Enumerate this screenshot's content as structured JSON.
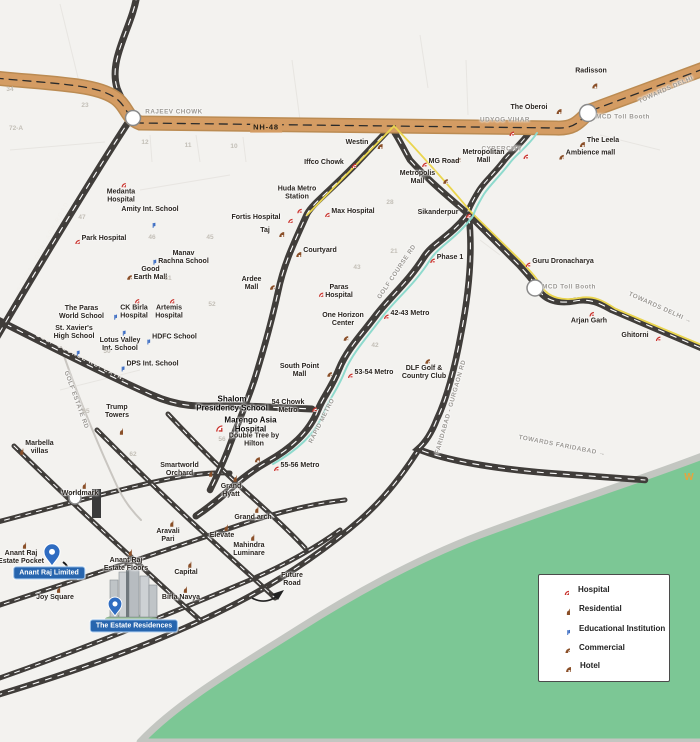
{
  "colors": {
    "nh48_orange": "#d49c63",
    "road_dark": "#3f3c39",
    "rapid_metro_teal": "#8edacd",
    "metro_line_yellow": "#ead54e",
    "green_area": "#7cc795",
    "badge_blue": "#2765ae",
    "pin_blue": "#2f6cc1",
    "icon_brown": "#8a4f28",
    "metro_red": "#c9342e",
    "edu_blue": "#3f6fc4"
  },
  "legend": {
    "items": [
      {
        "icon": "hosp",
        "label": "Hospital"
      },
      {
        "icon": "res",
        "label": "Residential"
      },
      {
        "icon": "edu",
        "label": "Educational Institution"
      },
      {
        "icon": "comm",
        "label": "Commercial"
      },
      {
        "icon": "hotel",
        "label": "Hotel"
      }
    ]
  },
  "places": [
    {
      "n": "rajeev-chowk",
      "l": "RAJEEV CHOWK",
      "x": 174,
      "y": 112,
      "c": "cap"
    },
    {
      "n": "udyog-vihar",
      "l": "UDYOG VIHAR",
      "x": 505,
      "y": 120,
      "c": "cap"
    },
    {
      "n": "mcd-toll-booth-top",
      "l": "MCD Toll Booth",
      "x": 623,
      "y": 117,
      "c": "cap"
    },
    {
      "n": "towards-delhi-top",
      "l": "TOWARDS DELHI",
      "x": 666,
      "y": 90,
      "c": "cap",
      "r": -24
    },
    {
      "n": "cybercity",
      "l": "CYBERCITY",
      "x": 502,
      "y": 149,
      "c": "cap"
    },
    {
      "n": "mcd-toll-booth-right",
      "l": "MCD Toll Booth",
      "x": 569,
      "y": 287,
      "c": "cap"
    },
    {
      "n": "towards-delhi-right",
      "l": "TOWARDS DELHI →",
      "x": 660,
      "y": 308,
      "c": "cap",
      "r": 24
    },
    {
      "n": "towards-faridabad",
      "l": "TOWARDS FARIDABAD →",
      "x": 562,
      "y": 446,
      "c": "cap",
      "r": 11
    },
    {
      "n": "sohna-gurgaon-road",
      "l": "SOHNA - GURGAON ROAD",
      "x": 44,
      "y": 247,
      "c": "onroad",
      "r": -61
    },
    {
      "n": "golf-course-rd-extn",
      "l": "GOLF COURSE RD. EXTN.",
      "x": 80,
      "y": 358,
      "c": "onroad",
      "r": 27
    },
    {
      "n": "nh-48",
      "l": "NH-48",
      "x": 266,
      "y": 128,
      "c": "nh"
    },
    {
      "n": "golf-estate-rd",
      "l": "GOLF ESTATE RD",
      "x": 76,
      "y": 400,
      "c": "cap",
      "r": 70
    },
    {
      "n": "golf-course-rd",
      "l": "GOLF COURSE RD",
      "x": 397,
      "y": 272,
      "c": "cap",
      "r": -56
    },
    {
      "n": "rapid-metro",
      "l": "RAPID METRO",
      "x": 322,
      "y": 421,
      "c": "cap",
      "r": -63
    },
    {
      "n": "faridabad-gurgaon-rd",
      "l": "FARIDABAD - GURGAON RD",
      "x": 451,
      "y": 407,
      "c": "cap",
      "r": -74
    },
    {
      "n": "radisson",
      "l": "Radisson",
      "x": 591,
      "y": 78,
      "ic": "hotel",
      "s": "bottom"
    },
    {
      "n": "the-oberoi",
      "l": "The Oberoi",
      "x": 536,
      "y": 108,
      "ic": "hotel",
      "s": "right"
    },
    {
      "n": "the-leela",
      "l": "The Leela",
      "x": 596,
      "y": 141,
      "ic": "hotel",
      "s": "left"
    },
    {
      "n": "westin",
      "l": "Westin",
      "x": 364,
      "y": 143,
      "ic": "hotel",
      "s": "right"
    },
    {
      "n": "taj",
      "l": "Taj",
      "x": 272,
      "y": 231,
      "ic": "hotel",
      "s": "right"
    },
    {
      "n": "courtyard",
      "l": "Courtyard",
      "x": 313,
      "y": 251,
      "ic": "hotel",
      "s": "left"
    },
    {
      "n": "double-tree-hilton",
      "l": "Double Tree by\nHilton",
      "x": 254,
      "y": 447,
      "ic": "hotel",
      "s": "bottom"
    },
    {
      "n": "ambience-mall",
      "l": "Ambience mall",
      "x": 584,
      "y": 154,
      "ic": "comm",
      "s": "left"
    },
    {
      "n": "metropolitan-mall",
      "l": "Metropolitan\nMall",
      "x": 477,
      "y": 157,
      "ic": "comm",
      "s": "left"
    },
    {
      "n": "metropolis-mall",
      "l": "Metropolis\nMall",
      "x": 424,
      "y": 178,
      "ic": "comm",
      "s": "right"
    },
    {
      "n": "good-earth-mall",
      "l": "Good\nEarth Mall",
      "x": 144,
      "y": 274,
      "ic": "comm",
      "s": "left"
    },
    {
      "n": "ardee-mall",
      "l": "Ardee\nMall",
      "x": 258,
      "y": 284,
      "ic": "comm",
      "s": "right"
    },
    {
      "n": "one-horizon-center",
      "l": "One Horizon\nCenter",
      "x": 343,
      "y": 326,
      "ic": "comm",
      "s": "bottom"
    },
    {
      "n": "south-point-mall",
      "l": "South Point\nMall",
      "x": 306,
      "y": 371,
      "ic": "comm",
      "s": "right"
    },
    {
      "n": "dlf-golf-country-club",
      "l": "DLF Golf &\nCountry Club",
      "x": 424,
      "y": 367,
      "ic": "comm",
      "s": "top"
    },
    {
      "n": "medanta-hospital",
      "l": "Medanta\nHospital",
      "x": 121,
      "y": 191,
      "ic": "hosp",
      "s": "top"
    },
    {
      "n": "park-hospital",
      "l": "Park Hospital",
      "x": 98,
      "y": 239,
      "ic": "hosp",
      "s": "left"
    },
    {
      "n": "ck-birla-hospital",
      "l": "CK Birla\nHospital",
      "x": 134,
      "y": 307,
      "ic": "hosp",
      "s": "top"
    },
    {
      "n": "artemis-hospital",
      "l": "Artemis\nHospital",
      "x": 169,
      "y": 307,
      "ic": "hosp",
      "s": "top"
    },
    {
      "n": "fortis-hospital",
      "l": "Fortis Hospital",
      "x": 262,
      "y": 218,
      "ic": "hosp",
      "s": "right"
    },
    {
      "n": "max-hospital",
      "l": "Max Hospital",
      "x": 347,
      "y": 212,
      "ic": "hosp",
      "s": "left"
    },
    {
      "n": "paras-hospital",
      "l": "Paras\nHospital",
      "x": 333,
      "y": 292,
      "ic": "hosp",
      "s": "left"
    },
    {
      "n": "amity-school",
      "l": "Amity Int. School",
      "x": 150,
      "y": 217,
      "ic": "edu",
      "s": "bottom"
    },
    {
      "n": "manav-rachna-school",
      "l": "Manav\nRachna School",
      "x": 177,
      "y": 258,
      "ic": "edu",
      "s": "left"
    },
    {
      "n": "paras-world-school",
      "l": "The Paras\nWorld School",
      "x": 88,
      "y": 313,
      "ic": "edu",
      "s": "right"
    },
    {
      "n": "lotus-valley-school",
      "l": "Lotus Valley\nInt. School",
      "x": 120,
      "y": 338,
      "ic": "edu",
      "s": "top"
    },
    {
      "n": "hdfc-school",
      "l": "HDFC School",
      "x": 168,
      "y": 338,
      "ic": "edu",
      "s": "left"
    },
    {
      "n": "st-xaviers-school",
      "l": "St. Xavier's\nHigh School",
      "x": 74,
      "y": 340,
      "ic": "edu",
      "s": "bottom"
    },
    {
      "n": "dps-school",
      "l": "DPS Int. School",
      "x": 146,
      "y": 365,
      "ic": "edu",
      "s": "left"
    },
    {
      "n": "iffco-chowk-metro",
      "l": "Iffco Chowk",
      "x": 330,
      "y": 163,
      "ic": "metro",
      "s": "right"
    },
    {
      "n": "mg-road-metro",
      "l": "MG Road",
      "x": 438,
      "y": 162,
      "ic": "metro",
      "s": "left"
    },
    {
      "n": "huda-metro-station",
      "l": "Huda Metro\nStation",
      "x": 297,
      "y": 199,
      "ic": "metro",
      "s": "bottom"
    },
    {
      "n": "sikanderpur-metro",
      "l": "Sikanderpur",
      "x": 444,
      "y": 213,
      "ic": "metro",
      "s": "right"
    },
    {
      "n": "phase-1-metro",
      "l": "Phase 1",
      "x": 444,
      "y": 258,
      "ic": "metro",
      "s": "left"
    },
    {
      "n": "metro-42-43",
      "l": "42-43 Metro",
      "x": 404,
      "y": 314,
      "ic": "metro",
      "s": "left"
    },
    {
      "n": "metro-53-54",
      "l": "53-54 Metro",
      "x": 368,
      "y": 373,
      "ic": "metro",
      "s": "left"
    },
    {
      "n": "metro-54-chowk",
      "l": "54 Chowk\nMetro",
      "x": 294,
      "y": 407,
      "ic": "metro",
      "s": "right"
    },
    {
      "n": "metro-55-56",
      "l": "55-56 Metro",
      "x": 294,
      "y": 466,
      "ic": "metro",
      "s": "left"
    },
    {
      "n": "guru-dronacharya-metro",
      "l": "Guru Dronacharya",
      "x": 557,
      "y": 262,
      "ic": "metro",
      "s": "left"
    },
    {
      "n": "arjan-garh-metro",
      "l": "Arjan Garh",
      "x": 589,
      "y": 316,
      "ic": "metro",
      "s": "top"
    },
    {
      "n": "ghitorni-metro",
      "l": "Ghitorni",
      "x": 641,
      "y": 336,
      "ic": "metro",
      "s": "right"
    },
    {
      "n": "udyog-vihar-metro",
      "l": "",
      "x": 509,
      "y": 131,
      "ic": "metro"
    },
    {
      "n": "cybercity-metro",
      "l": "",
      "x": 523,
      "y": 154,
      "ic": "metro"
    },
    {
      "n": "shalom-presidency-school",
      "l": "Shalom\nPresidency School",
      "x": 232,
      "y": 404,
      "c": "big"
    },
    {
      "n": "marengo-asia-hospital",
      "l": "Marengo Asia\nHospital",
      "x": 243,
      "y": 425,
      "ic": "cross",
      "s": "left",
      "c": "big"
    },
    {
      "n": "trump-towers",
      "l": "Trump\nTowers",
      "x": 117,
      "y": 419,
      "ic": "res",
      "s": "bottom"
    },
    {
      "n": "marbella-villas",
      "l": "Marbella\nvillas",
      "x": 33,
      "y": 448,
      "ic": "res",
      "s": "left"
    },
    {
      "n": "worldmark",
      "l": "Worldmark",
      "x": 80,
      "y": 487,
      "ic": "res",
      "s": "top"
    },
    {
      "n": "smartworld-orchard",
      "l": "Smartworld\nOrchard",
      "x": 186,
      "y": 470,
      "ic": "res",
      "s": "right"
    },
    {
      "n": "grand-hyatt",
      "l": "Grand\nHyatt",
      "x": 231,
      "y": 484,
      "ic": "res",
      "s": "top"
    },
    {
      "n": "grand-arch",
      "l": "Grand arch",
      "x": 253,
      "y": 511,
      "ic": "res",
      "s": "top"
    },
    {
      "n": "elevate",
      "l": "Elevate",
      "x": 222,
      "y": 529,
      "ic": "res",
      "s": "top"
    },
    {
      "n": "mahindra-luminare",
      "l": "Mahindra\nLuminare",
      "x": 249,
      "y": 543,
      "ic": "res",
      "s": "top"
    },
    {
      "n": "aravali-pari",
      "l": "Aravali\nPari",
      "x": 168,
      "y": 529,
      "ic": "res",
      "s": "top"
    },
    {
      "n": "capital",
      "l": "Capital",
      "x": 186,
      "y": 566,
      "ic": "res",
      "s": "top"
    },
    {
      "n": "birla-navya",
      "l": "Birla Navya",
      "x": 181,
      "y": 591,
      "ic": "res",
      "s": "top"
    },
    {
      "n": "anant-raj-estate-pocket",
      "l": "Anant Raj\nEstate Pocket",
      "x": 21,
      "y": 551,
      "ic": "res",
      "s": "top"
    },
    {
      "n": "joy-square",
      "l": "Joy Square",
      "x": 55,
      "y": 591,
      "ic": "res",
      "s": "top"
    },
    {
      "n": "anant-raj-estate-floors",
      "l": "Anant Raj\nEstate Floors",
      "x": 126,
      "y": 558,
      "ic": "res",
      "s": "top"
    },
    {
      "n": "future-road",
      "l": "Future\nRoad",
      "x": 292,
      "y": 580
    },
    {
      "n": "anant-raj-limited-badge",
      "l": "Anant Raj Limited",
      "x": 49,
      "y": 573,
      "c": "badge",
      "i": true
    },
    {
      "n": "the-estate-residences-badge",
      "l": "The Estate Residences",
      "x": 134,
      "y": 626,
      "c": "badge",
      "i": true
    },
    {
      "n": "watermark-w",
      "l": "W",
      "x": 689,
      "y": 478,
      "c": "wm"
    }
  ],
  "sector_numbers": [
    {
      "v": "34",
      "x": 10,
      "y": 90
    },
    {
      "v": "23",
      "x": 85,
      "y": 106
    },
    {
      "v": "72-A",
      "x": 16,
      "y": 129
    },
    {
      "v": "12",
      "x": 145,
      "y": 143
    },
    {
      "v": "11",
      "x": 188,
      "y": 146
    },
    {
      "v": "10",
      "x": 234,
      "y": 147
    },
    {
      "v": "28",
      "x": 390,
      "y": 203
    },
    {
      "v": "47",
      "x": 82,
      "y": 218
    },
    {
      "v": "46",
      "x": 152,
      "y": 238
    },
    {
      "v": "45",
      "x": 210,
      "y": 238
    },
    {
      "v": "21",
      "x": 394,
      "y": 252
    },
    {
      "v": "43",
      "x": 357,
      "y": 268
    },
    {
      "v": "51",
      "x": 168,
      "y": 279
    },
    {
      "v": "52",
      "x": 212,
      "y": 305
    },
    {
      "v": "50",
      "x": 107,
      "y": 352
    },
    {
      "v": "42",
      "x": 375,
      "y": 346
    },
    {
      "v": "65",
      "x": 86,
      "y": 412
    },
    {
      "v": "56",
      "x": 222,
      "y": 440
    },
    {
      "v": "62",
      "x": 133,
      "y": 455
    }
  ]
}
